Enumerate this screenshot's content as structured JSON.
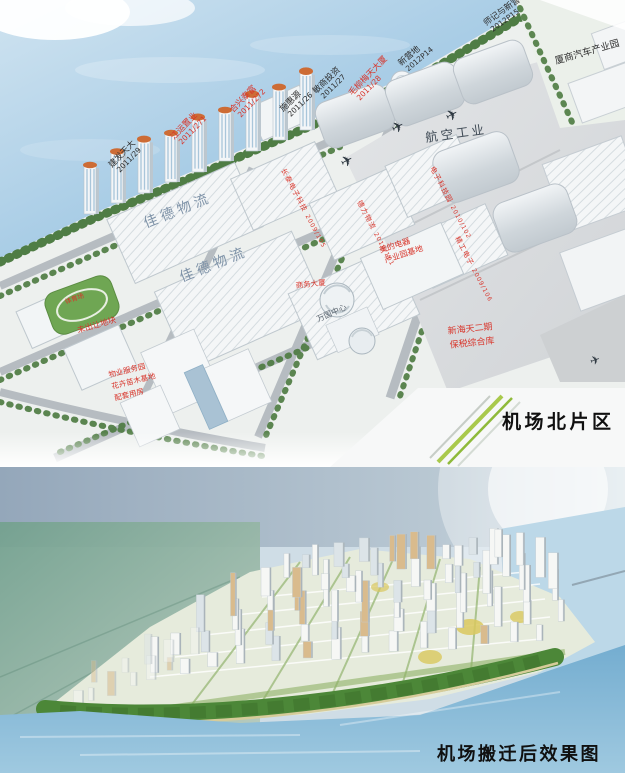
{
  "colors": {
    "label_red": "#d8352b",
    "label_dark": "#2e2e2e",
    "water_top": "#a9cde6",
    "water_bottom": "#8fc0dc",
    "roof_text": "#7f93a8",
    "tree_green": "#47763b",
    "park_green": "#4c8738",
    "caption_text": "#101010"
  },
  "top_panel": {
    "caption": "机场北片区",
    "plots": [
      {
        "name": "建发天大",
        "code": "2011/29"
      },
      {
        "name": "江运置业",
        "code": "2011/271"
      },
      {
        "name": "合兴泰富",
        "code": "2011/272"
      },
      {
        "name": "施惠源",
        "code": "2011/26"
      },
      {
        "name": "敏商投资",
        "code": "2011/27"
      },
      {
        "name": "毛柳梅天大厦",
        "code": "2011/28"
      },
      {
        "name": "新营地",
        "code": "2012P14"
      },
      {
        "name": "师记与新营地",
        "code": "2012P15"
      }
    ],
    "labels": {
      "auto_park": "厦商汽车产业园",
      "aviation": "航空工业",
      "logistics_a": "佳德物流",
      "logistics_b": "佳德物流",
      "bonded_1": "新海天二期",
      "bonded_2": "保税综合库",
      "stadium": "体育场",
      "unassigned": "未出让地块",
      "services_1": "物业服务园",
      "services_2": "花卉苗木基地",
      "services_3": "配套用房",
      "center": "万国中心",
      "tower": "商务大厦",
      "appliance_1": "美的电器",
      "appliance_2": "产业园基地"
    },
    "roof_plots": [
      {
        "name": "长泰电子科技",
        "code": "2009/105"
      },
      {
        "name": "德力物流",
        "code": "2010/101"
      },
      {
        "name": "电子科技园",
        "code": "2010/102"
      },
      {
        "name": "精工电子",
        "code": "2009/106"
      }
    ]
  },
  "bottom_panel": {
    "caption": "机场搬迁后效果图"
  }
}
